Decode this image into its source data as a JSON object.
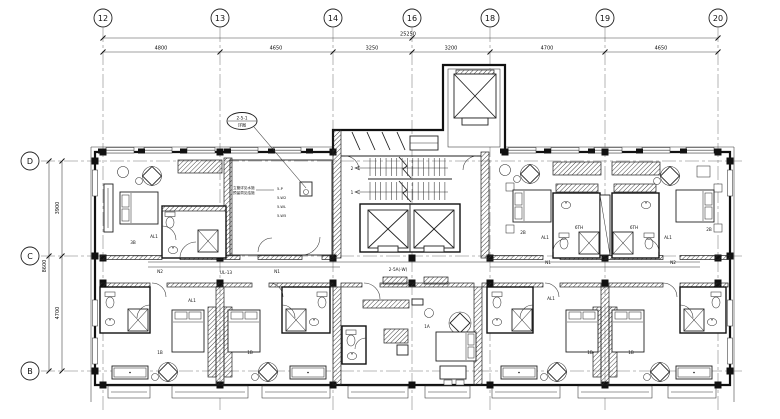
{
  "grid": {
    "top": [
      "12",
      "13",
      "14",
      "16",
      "18",
      "19",
      "20"
    ],
    "left": [
      "D",
      "C",
      "B"
    ]
  },
  "dimensions": {
    "top_total": "25250",
    "top_bays": [
      "4800",
      "4650",
      "3250",
      "3200",
      "4700",
      "4650"
    ],
    "left_total": "8600",
    "left_bays": [
      "3900",
      "4700"
    ]
  },
  "callout": {
    "line1": "2-5-1",
    "line2": "详图"
  },
  "notes": {
    "line1": "立管详见水施",
    "line2": "预留洞见结施"
  },
  "pipe_labels": [
    "5-P",
    "5-W2",
    "5-WL",
    "5-W5"
  ],
  "stairs": {
    "flight_up": "2",
    "flight_down": "1"
  },
  "corridor_labels": {
    "n2": "N2",
    "ul13": "UL-13",
    "n1": "N1",
    "w": "2-5A(-W)",
    "n1b": "N1",
    "n2b": "N2"
  },
  "room_labels": {
    "top_left": "3B",
    "top_right_1": "2B",
    "top_right_2": "2B",
    "bath_1": "6TH",
    "bath_2": "6TH",
    "bottom_1": "1B",
    "bottom_2": "1B",
    "bottom_3": "1B",
    "bottom_4": "1B",
    "suite": "1A",
    "al1": "AL1"
  }
}
